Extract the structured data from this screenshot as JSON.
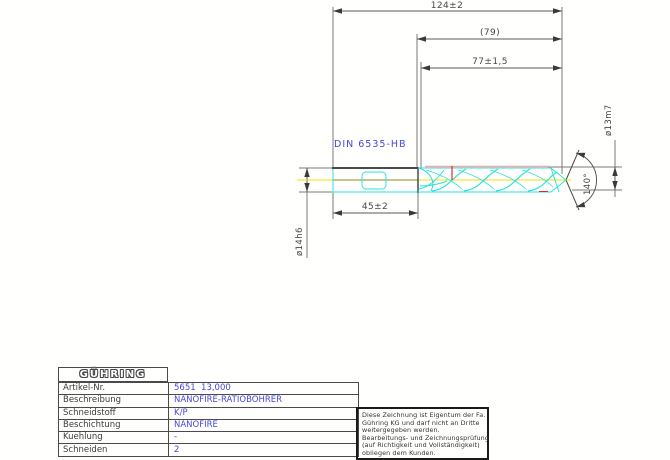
{
  "drawing": {
    "standard_label": "DIN 6535-HB",
    "dim_overall": "124±2",
    "dim_ref": "(79)",
    "dim_flute": "77±1,5",
    "dim_shank": "45±2",
    "dim_shank_dia": "ø14h6",
    "dim_cut_dia": "ø13m7",
    "dim_point_angle": "140°",
    "colors": {
      "tool_outline": "#2ee0e0",
      "centerline": "#f0e000",
      "margin_line": "#ffa0a0",
      "marking": "#d83030",
      "annotation_blue": "#4646d8",
      "dimension_gray": "#5a5a5a"
    }
  },
  "table": {
    "logo": "GÜHRING",
    "rows": [
      {
        "label": "Artikel-Nr.",
        "value": "5651  13,000"
      },
      {
        "label": "Beschreibung",
        "value": "NANOFIRE-RATIOBOHRER"
      },
      {
        "label": "Schneidstoff",
        "value": "K/P"
      },
      {
        "label": "Beschichtung",
        "value": "NANOFIRE"
      },
      {
        "label": "Kuehlung",
        "value": "-"
      },
      {
        "label": "Schneiden",
        "value": "2"
      }
    ]
  },
  "disclaimer": {
    "lines": [
      "Diese Zeichnung ist Eigentum der Fa.",
      "Gühring KG und darf nicht an Dritte",
      "weitergegeben werden.",
      "Bearbeitungs- und Zeichnungsprüfung",
      "(auf Richtigkeit und Vollständigkeit)",
      "obliegen dem Kunden."
    ]
  }
}
